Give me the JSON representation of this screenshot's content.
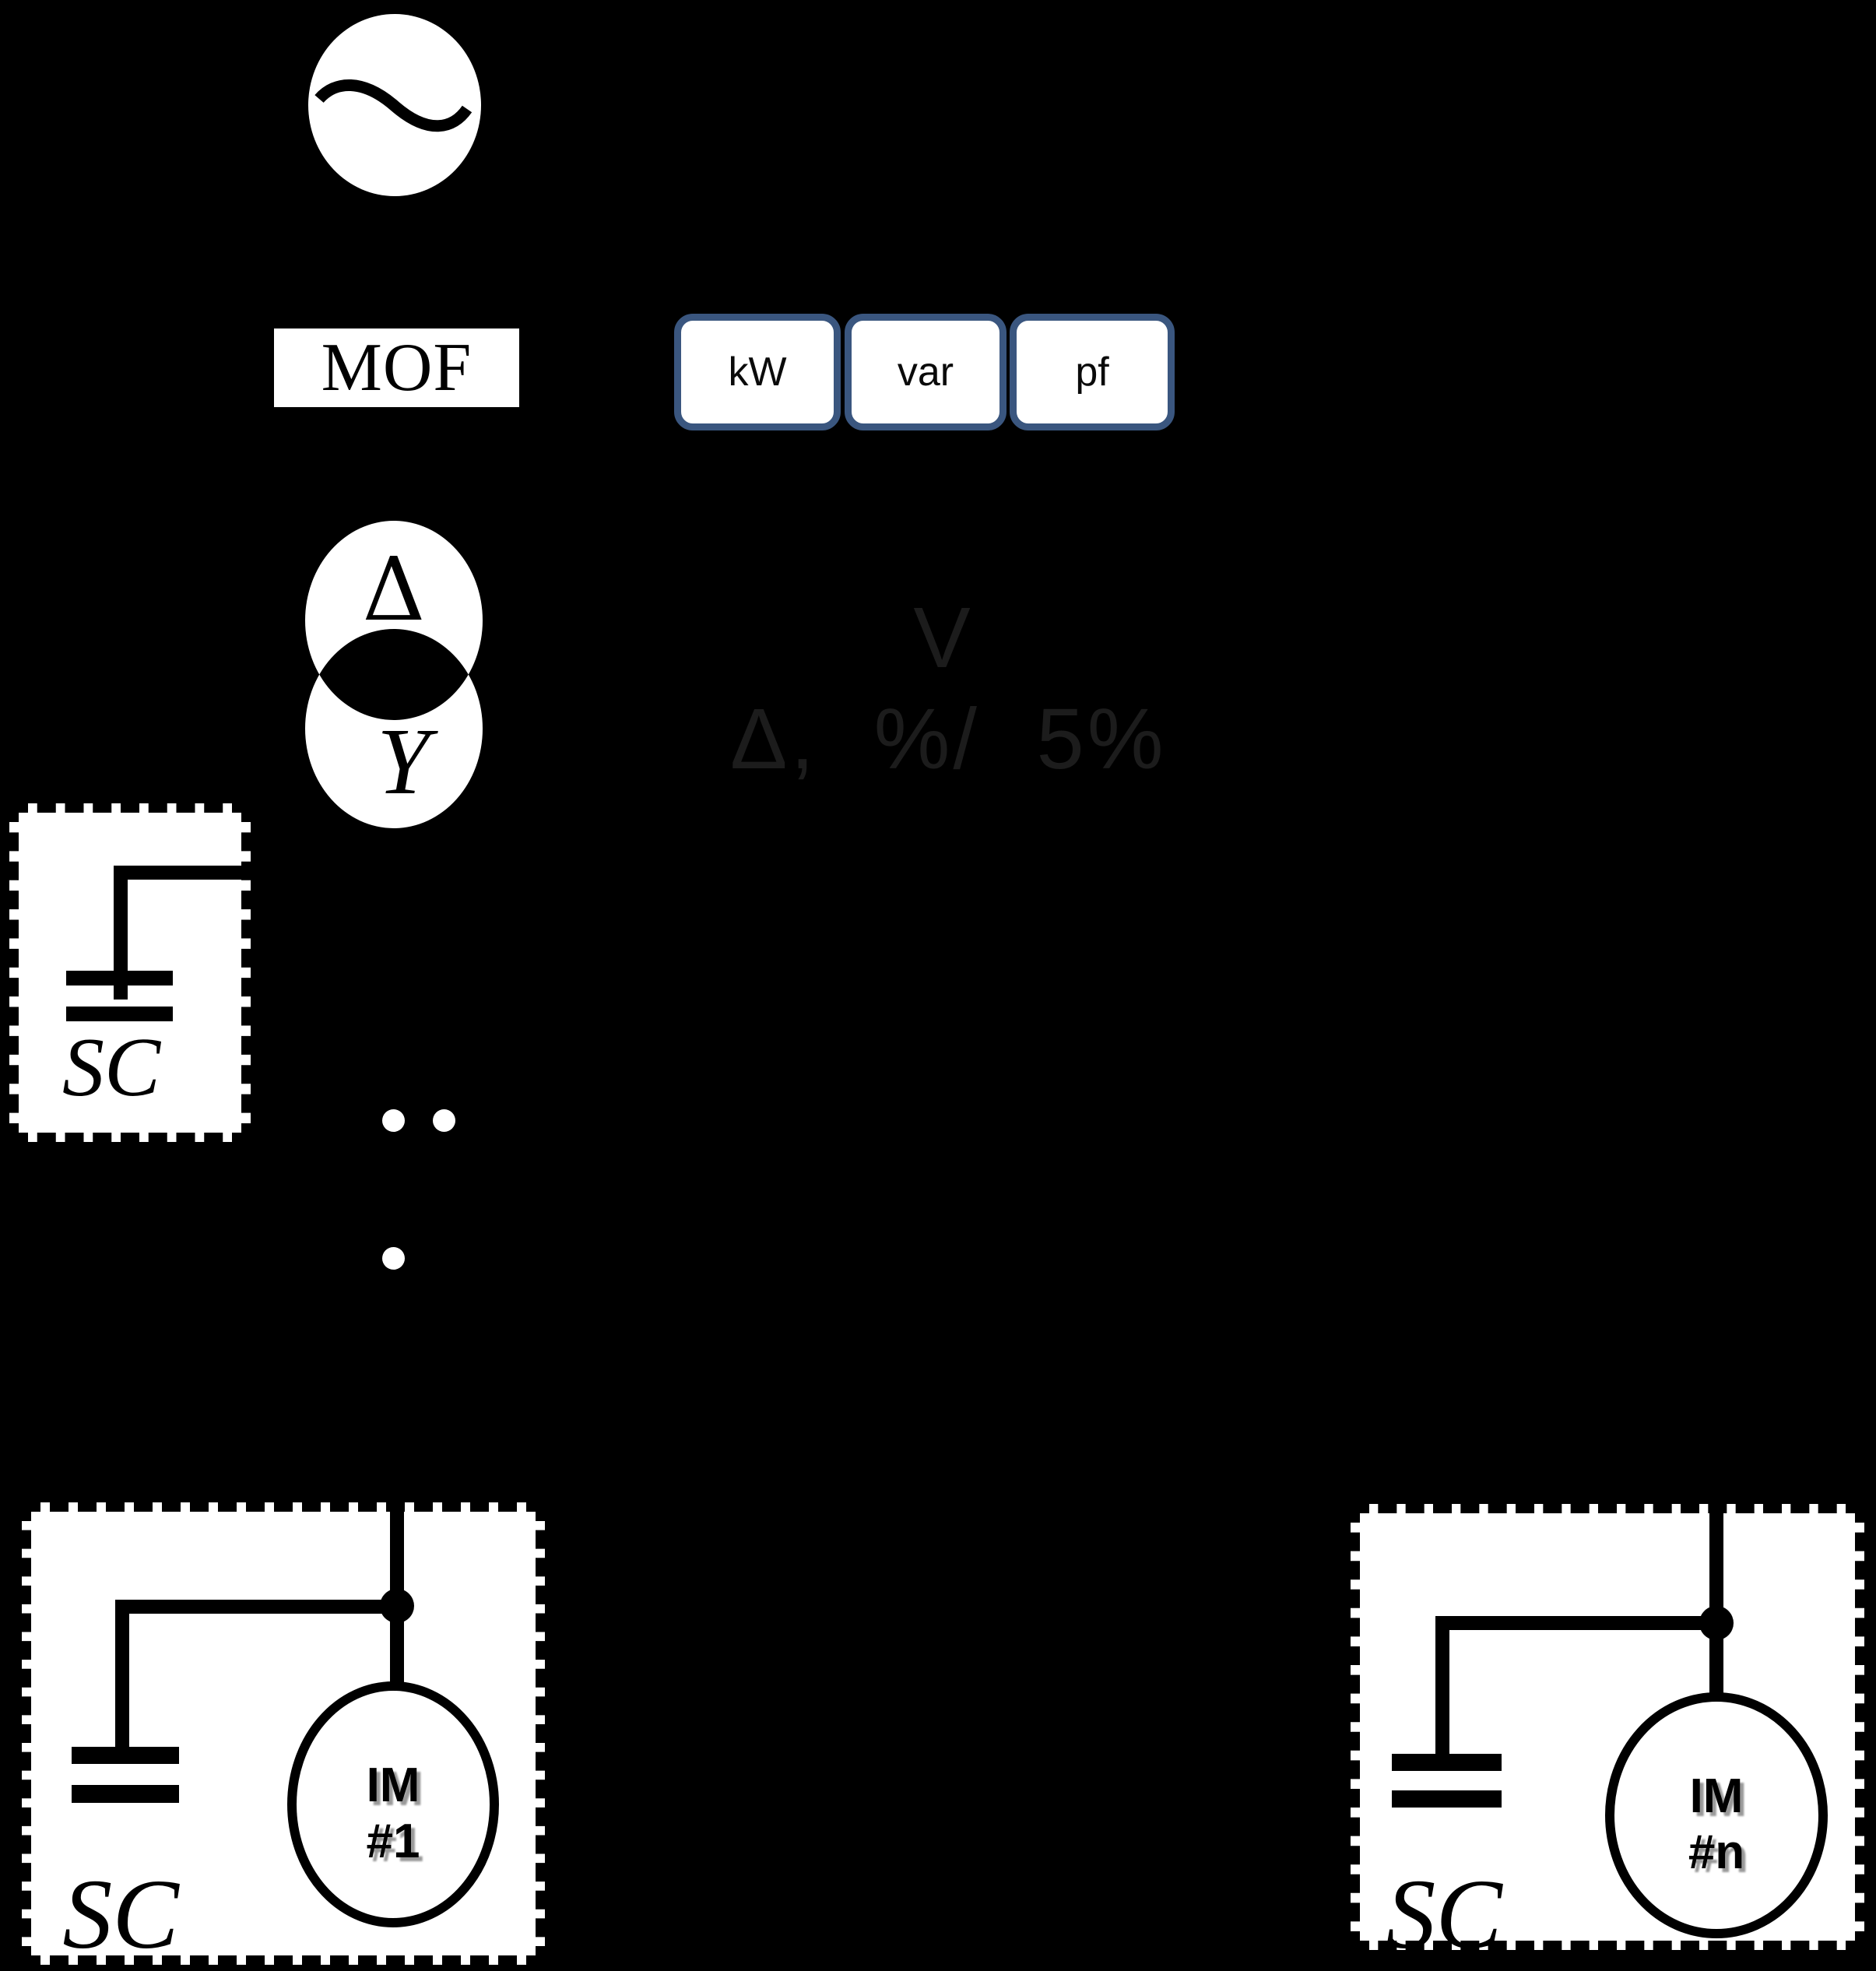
{
  "diagram_title": "power-system single-line diagram",
  "colors": {
    "background": "#000000",
    "shape_fill": "#ffffff",
    "line": "#000000",
    "meter_border": "#3a567f",
    "faint_text": "#1c1c1c",
    "im_label_shadow": "#999999"
  },
  "mof": {
    "label": "MOF"
  },
  "meters": [
    {
      "label": "kW"
    },
    {
      "label": "var"
    },
    {
      "label": "pf"
    }
  ],
  "transformer": {
    "primary_symbol": "Δ",
    "secondary_symbol": "Y"
  },
  "regulation": {
    "line1": "V",
    "line2": "Δ, %/ 5%"
  },
  "station_capacitor": {
    "label": "SC"
  },
  "feeders": [
    {
      "capacitor_label": "SC",
      "motor_line1": "IM",
      "motor_line2": "#1"
    },
    {
      "capacitor_label": "SC",
      "motor_line1": "IM",
      "motor_line2": "#n"
    }
  ]
}
